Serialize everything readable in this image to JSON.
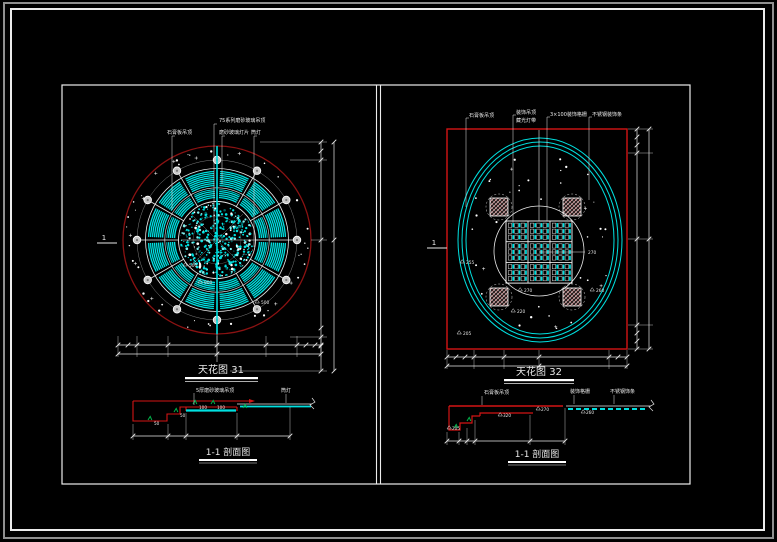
{
  "colors": {
    "background": "#000000",
    "frame_white": "#ececec",
    "frame_gray": "#8f8f8f",
    "red": "#d41414",
    "dark_red": "#8b1212",
    "cyan": "#00e0e0",
    "green": "#00b44a",
    "white": "#e8e8e8",
    "pink_hatch": "#d8a0a0",
    "lamp_fill": "#c8c8c8"
  },
  "left_plan": {
    "title": "天花图 31",
    "callouts": [
      "75系列磨砂玻璃吊顶",
      "石膏板吊顶",
      "磨砂玻璃灯片",
      "筒灯"
    ],
    "dim_labels": [
      "500",
      "900",
      "500"
    ],
    "section_marker": "1"
  },
  "right_plan": {
    "title": "天花图 32",
    "callouts": [
      "石膏板吊顶",
      "装饰吊顶",
      "藏光灯带",
      "3×100装饰格栅",
      "不锈钢装饰条"
    ],
    "elevation_labels": [
      "270",
      "220",
      "205",
      "260",
      "255",
      "270"
    ],
    "section_marker": "1"
  },
  "left_section": {
    "title": "1-1 剖面图",
    "callouts": [
      "5厚磨砂玻璃吊顶",
      "筒灯"
    ],
    "elevation_labels": [
      "50",
      "50",
      "100",
      "100"
    ]
  },
  "right_section": {
    "title": "1-1 剖面图",
    "callouts": [
      "石膏板吊顶",
      "装饰格栅",
      "不锈钢饰条"
    ],
    "elevation_labels": [
      "205",
      "320",
      "270",
      "260"
    ]
  }
}
